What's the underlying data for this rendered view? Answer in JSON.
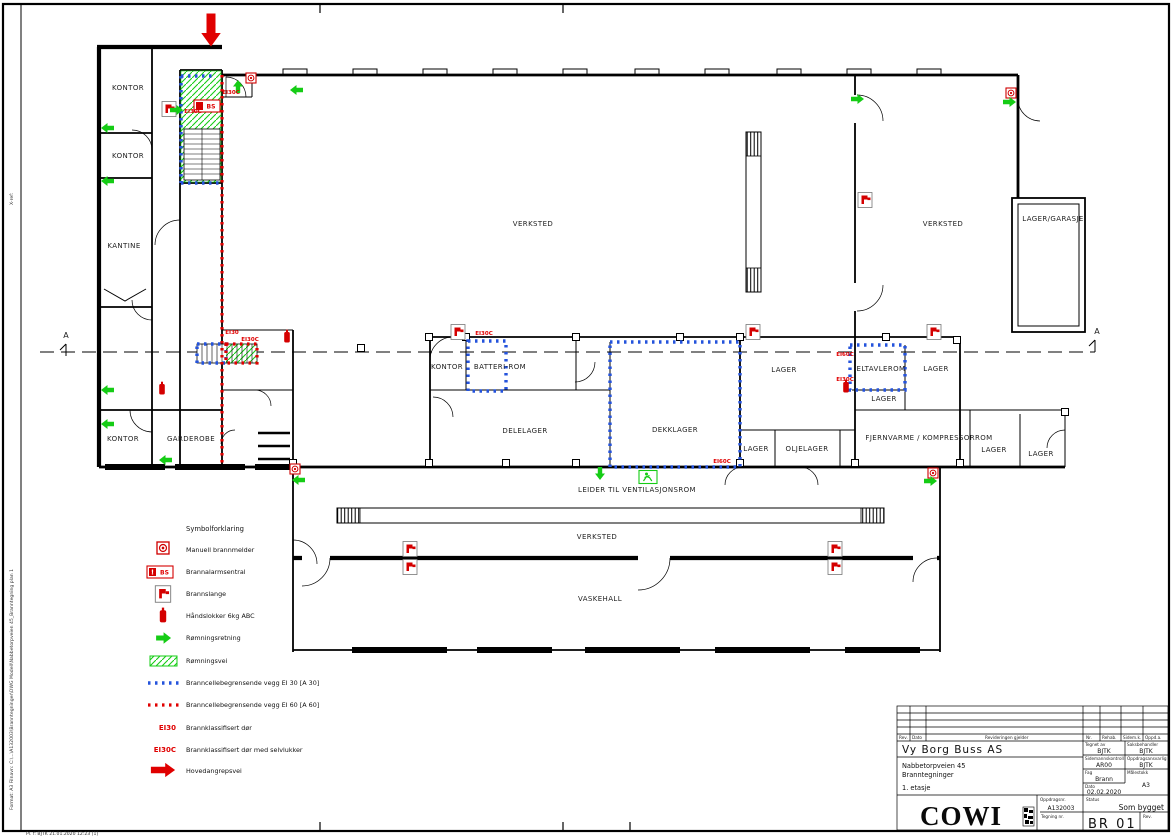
{
  "sheet": {
    "edge_stamp_xref": "X-ref:",
    "edge_stamp_left": "Format: A3    Filnavn: C:\\...\\A132003\\Branntegninger\\DWG Modell\\Nabbetorpveien 45_Branntegning plan 1",
    "bottom_stamp": "Pl. f: BJTK    21.01.2020 12:23 [1]"
  },
  "plan": {
    "section_marker": "A",
    "alarm_panel_badge": "BS",
    "rooms": [
      {
        "label": "KONTOR"
      },
      {
        "label": "KONTOR"
      },
      {
        "label": "KANTINE"
      },
      {
        "label": "KONTOR"
      },
      {
        "label": "GARDEROBE"
      },
      {
        "label": "VERKSTED"
      },
      {
        "label": "VERKSTED"
      },
      {
        "label": "LAGER/GARASJE"
      },
      {
        "label": "KONTOR"
      },
      {
        "label": "BATTERI-ROM"
      },
      {
        "label": "DELELAGER"
      },
      {
        "label": "DEKKLAGER"
      },
      {
        "label": "LAGER"
      },
      {
        "label": "LAGER"
      },
      {
        "label": "OLJELAGER"
      },
      {
        "label": "ELTAVLEROM"
      },
      {
        "label": "LAGER"
      },
      {
        "label": "LAGER"
      },
      {
        "label": "FJERNVARME / KOMPRESSORROM"
      },
      {
        "label": "LAGER"
      },
      {
        "label": "LAGER"
      },
      {
        "label": "LEIDER TIL VENTILASJONSROM"
      },
      {
        "label": "VERKSTED"
      },
      {
        "label": "VASKEHALL"
      }
    ],
    "door_labels": [
      {
        "text": "EI30C"
      },
      {
        "text": "EI30C"
      },
      {
        "text": "EI30"
      },
      {
        "text": "EI30C"
      },
      {
        "text": "EI30C"
      },
      {
        "text": "EI60C"
      },
      {
        "text": "EI60C"
      },
      {
        "text": "EI30C"
      }
    ]
  },
  "legend": {
    "title": "Symbolforklaring",
    "items": [
      {
        "icon": "manual-call-point-icon",
        "label": "Manuell brannmelder"
      },
      {
        "icon": "fire-alarm-panel-icon",
        "label": "Brannalarmsentral",
        "badge": "BS",
        "mark": "!"
      },
      {
        "icon": "fire-hose-icon",
        "label": "Brannslange"
      },
      {
        "icon": "fire-extinguisher-icon",
        "label": "Håndslokker 6kg ABC"
      },
      {
        "icon": "escape-direction-icon",
        "label": "Rømningsretning"
      },
      {
        "icon": "escape-route-icon",
        "label": "Rømningsvei"
      },
      {
        "icon": "fire-wall-ei30-icon",
        "label": "Branncellebegrensende vegg EI 30 [A 30]"
      },
      {
        "icon": "fire-wall-ei60-icon",
        "label": "Branncellebegrensende vegg EI 60 [A 60]"
      },
      {
        "icon": "fire-door-key",
        "key": "EI30",
        "label": "Brannklassifisert dør"
      },
      {
        "icon": "fire-door-closer-key",
        "key": "EI30C",
        "label": "Brannklassifisert dør med selvlukker"
      },
      {
        "icon": "main-attack-route-icon",
        "label": "Hovedangrepsvei"
      }
    ]
  },
  "title_block": {
    "client": "Vy Borg Buss AS",
    "address": "Nabbetorpveien 45",
    "subject": "Branntegninger",
    "floor": "1. etasje",
    "rev_header": {
      "rev": "Rev.",
      "date": "Dato",
      "desc": "Revideringen gjelder",
      "nr": "Nr.",
      "rehab": "Rehab.",
      "sidemk": "Sidem.k.",
      "oppda": "Oppd.a."
    },
    "fields": [
      {
        "label": "Tegnet av",
        "value": "BJTK"
      },
      {
        "label": "Saksbehandler",
        "value": "BJTK"
      },
      {
        "label": "Sidemannskontroll",
        "value": "AR00"
      },
      {
        "label": "Oppdragsansvarlig",
        "value": "BJTK"
      },
      {
        "label": "Fag",
        "value": "Brann"
      },
      {
        "label": "Målestokk",
        "value": "A3"
      },
      {
        "label": "Dato",
        "value": "02.02.2020"
      }
    ],
    "company": "COWI",
    "project_no_label": "Oppdragsnr.",
    "project_no": "A132003",
    "status_label": "Status",
    "status": "Som bygget",
    "drawing_no_label": "Tegning nr.",
    "drawing_no": "BR 01",
    "rev_label": "Rev."
  },
  "colors": {
    "fire_red": "#e00000",
    "escape_green": "#15cc15",
    "ei30_blue": "#2453dc",
    "wall_black": "#000000",
    "paper_white": "#ffffff"
  }
}
